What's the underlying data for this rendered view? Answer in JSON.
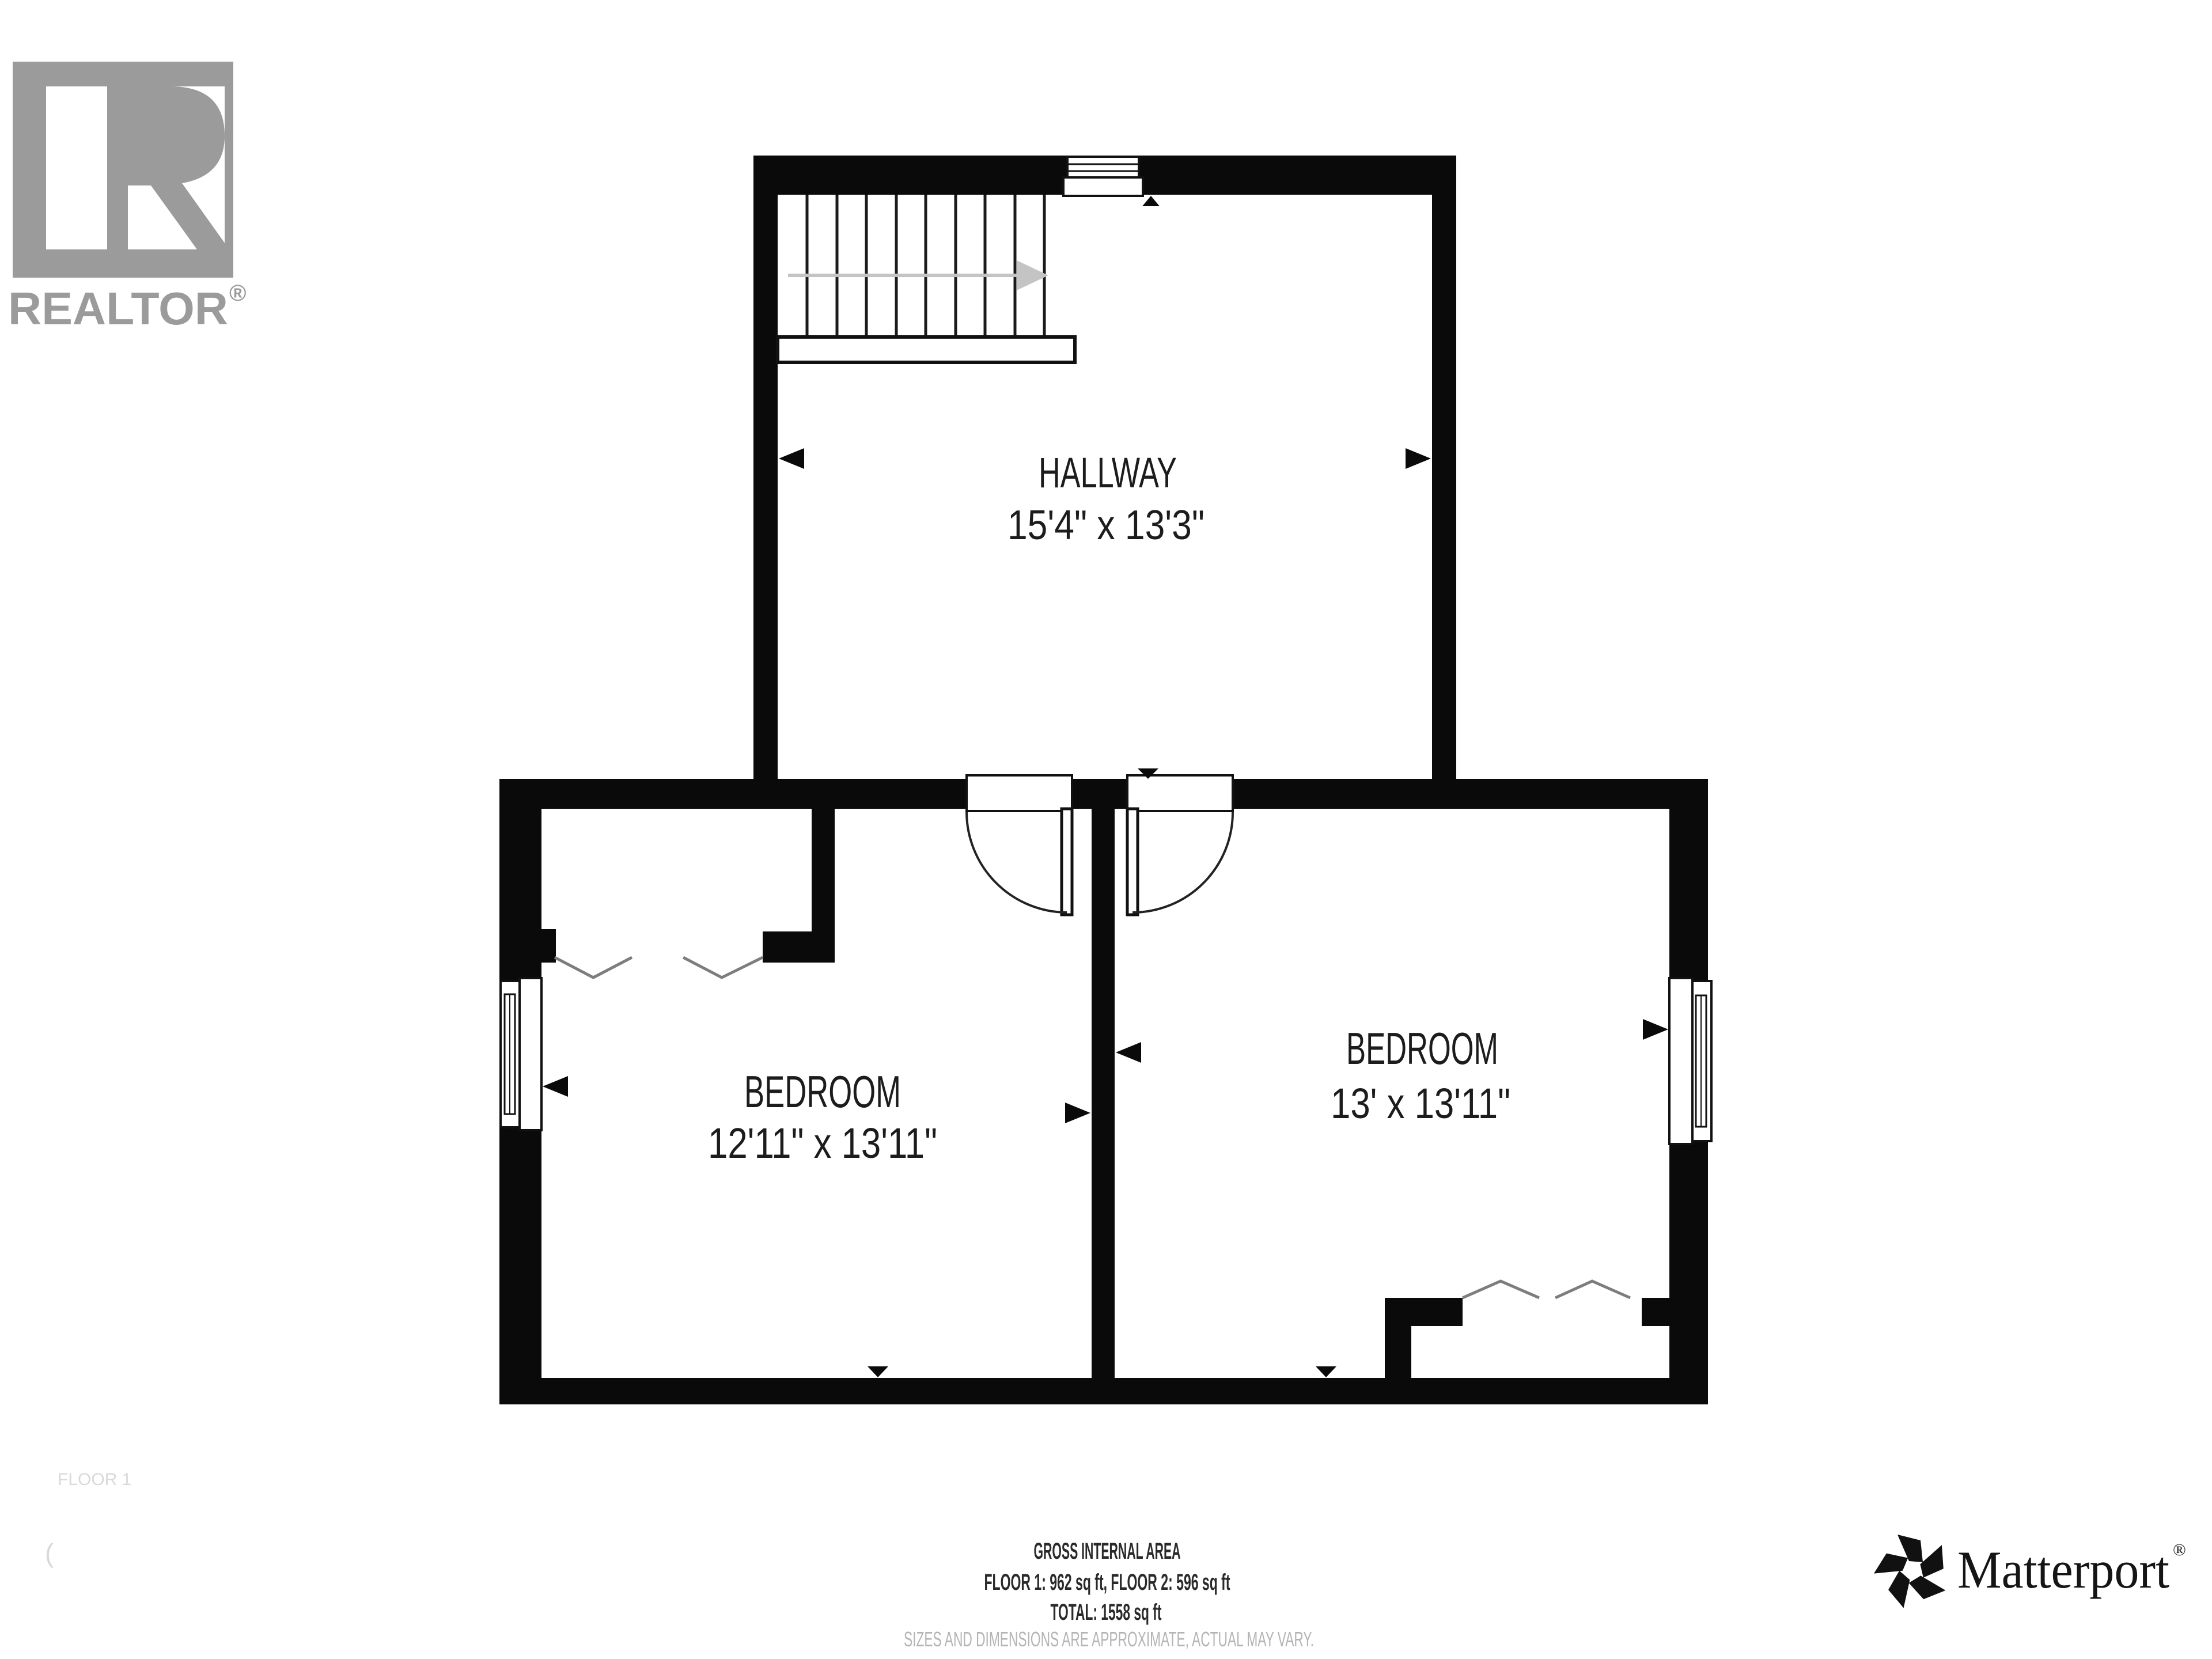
{
  "branding": {
    "realtor_logo_text": "REALTOR",
    "realtor_reg": "®",
    "matterport_text": "Matterport",
    "matterport_reg": "®"
  },
  "rooms": [
    {
      "name": "HALLWAY",
      "dimensions": "15'4\" x 13'3\""
    },
    {
      "name": "BEDROOM",
      "dimensions": "12'11\" x 13'11\""
    },
    {
      "name": "BEDROOM",
      "dimensions": "13' x 13'11\""
    }
  ],
  "footer": {
    "title": "GROSS INTERNAL AREA",
    "floors": "FLOOR 1: 962 sq ft, FLOOR 2: 596 sq ft",
    "total": "TOTAL: 1558 sq ft",
    "disclaimer": "SIZES AND DIMENSIONS ARE APPROXIMATE, ACTUAL MAY VARY."
  },
  "watermark": {
    "floor_label": "FLOOR 1",
    "paren": "("
  },
  "colors": {
    "wall": "#0a0a0a",
    "logo_gray": "#9b9b9b",
    "disclaimer_gray": "#b4b4b4",
    "stair_arrow_gray": "#c4c4c4"
  }
}
